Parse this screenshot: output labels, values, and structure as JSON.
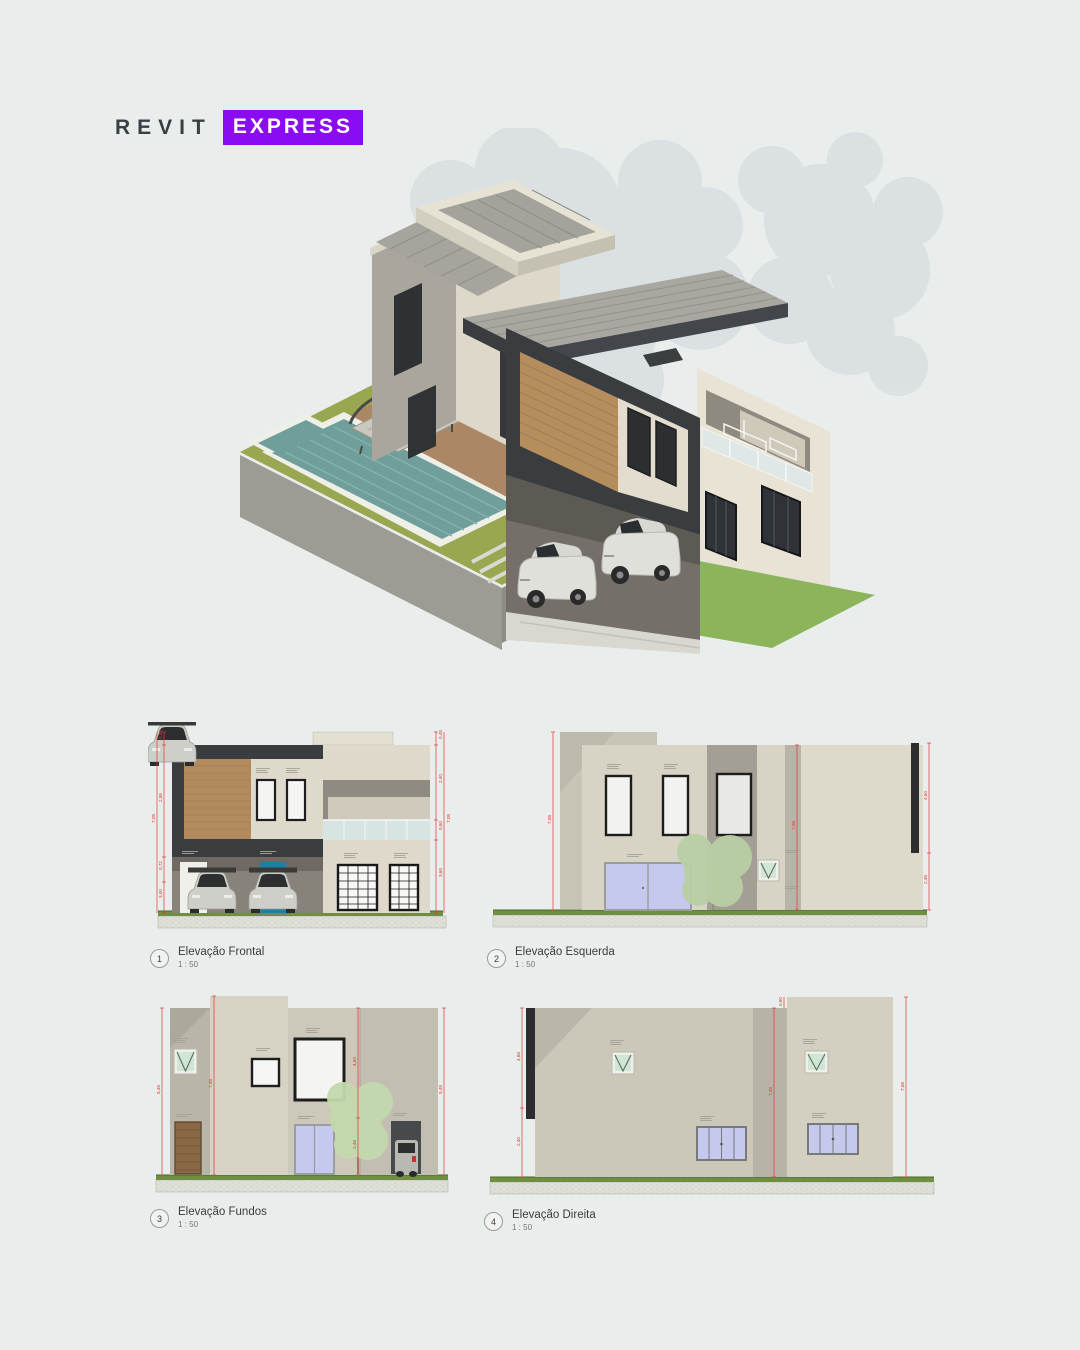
{
  "logo": {
    "brand": "REVIT",
    "badge": "EXPRESS"
  },
  "views": [
    {
      "number": "1",
      "title": "Elevação Frontal",
      "scale": "1 : 50"
    },
    {
      "number": "2",
      "title": "Elevação Esquerda",
      "scale": "1 : 50"
    },
    {
      "number": "3",
      "title": "Elevação Fundos",
      "scale": "1 : 50"
    },
    {
      "number": "4",
      "title": "Elevação Direita",
      "scale": "1 : 50"
    }
  ],
  "dims": {
    "frontal": {
      "left": [
        "0,48",
        "2,88",
        "0,72",
        "3,00"
      ],
      "left_total": "7,08",
      "right": [
        "0,48",
        "2,40",
        "0,60",
        "3,60"
      ],
      "right_total": "7,08"
    },
    "esquerda": {
      "left_total": "7,08",
      "mid_total": "7,08",
      "right": [
        "4,60",
        "2,48"
      ]
    },
    "fundos": {
      "left_total": "5,48",
      "tower_total": "7,08",
      "mid": [
        "4,60",
        "2,48"
      ],
      "right_total": "5,48"
    },
    "direita": {
      "left": [
        "4,68",
        "2,40"
      ],
      "mid_total": "7,08",
      "right_total": "7,68",
      "top": "0,60"
    }
  },
  "colors": {
    "background": "#e9eeec",
    "accent_purple": "#8a0df2",
    "dimension_red": "#e03535",
    "charcoal": "#3a3d40",
    "wood": "#b68d5d",
    "wall_beige": "#d7d3c5",
    "lavender_glass": "#c6c9ee",
    "green_glass": "#cfe6d4",
    "pool_water": "#6f9e9b",
    "lawn_green": "#8cb45a"
  }
}
